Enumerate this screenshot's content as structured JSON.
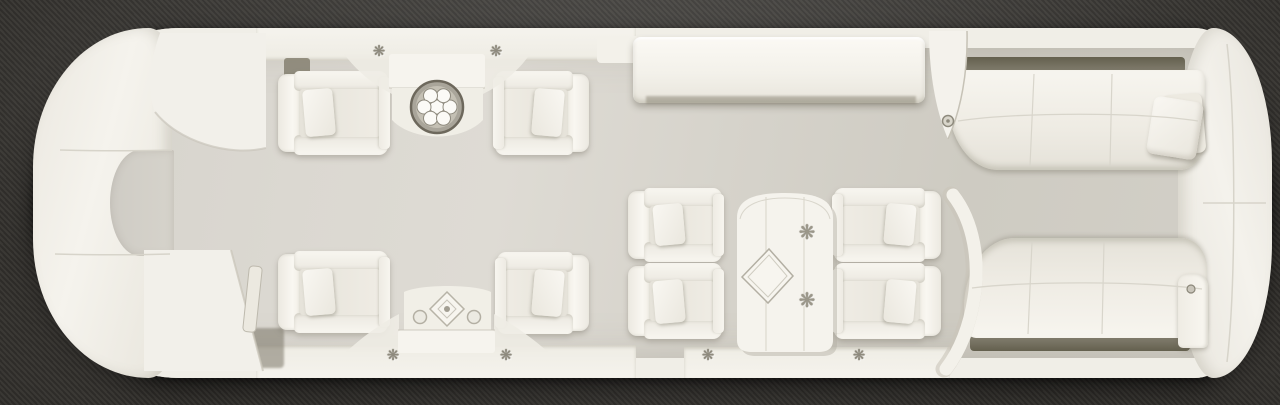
{
  "title": "Aircraft cabin floor plan — top view",
  "colors": {
    "background_fabric_dark": "#2e2c29",
    "background_fabric_light": "#3b3935",
    "fuselage_shell_white": "#f0eee7",
    "furniture_white": "#f6f4ee",
    "floor_gray": "#d6d3cb",
    "shadow_gap_olive": "#6f6a5b",
    "ornament_silver": "#948f82"
  },
  "zones": {
    "nose": {
      "label": "Nose bulkhead"
    },
    "entry": {
      "label": "Forward entry with curved partition and wardrobe"
    },
    "forward_lounge": {
      "label": "Forward club lounge: two pairs of facing armchairs with cocktail tables"
    },
    "mid_cabin": {
      "label": "Mid cabin: sideboard credenza opposite four-chair conference group"
    },
    "aft_lounge": {
      "label": "Aft lounge: two three-seat divans"
    },
    "tail": {
      "label": "Aft bulkhead / tail"
    }
  },
  "furniture": {
    "club_chair": "Club armchair",
    "conference_chair": "Conference armchair",
    "divan": "Three-seat divan",
    "side_table_top": "Cocktail table with round drink tray",
    "side_table_bottom": "Cocktail table with square inlay motif",
    "credenza": "Sideboard credenza",
    "conference_table": "Arch-top conference table",
    "placemat": "Diamond table mat",
    "drink_tray": "Drink tray with six glasses",
    "pillow": "Throw pillow",
    "armrest": "Divan armrest",
    "partition_forward": "Curved entry partition",
    "wardrobe": "Wardrobe cabinet with door handle",
    "partition_mid": "Mid-cabin partition blade",
    "partition_aft": "Curved aft partition",
    "ornament": "Flower ornament"
  },
  "counts": {
    "club_chairs": 4,
    "conference_chairs": 4,
    "divans": 2,
    "cocktail_tables": 2,
    "flower_ornaments": 8
  },
  "glyphs": {
    "flower": "❋"
  }
}
